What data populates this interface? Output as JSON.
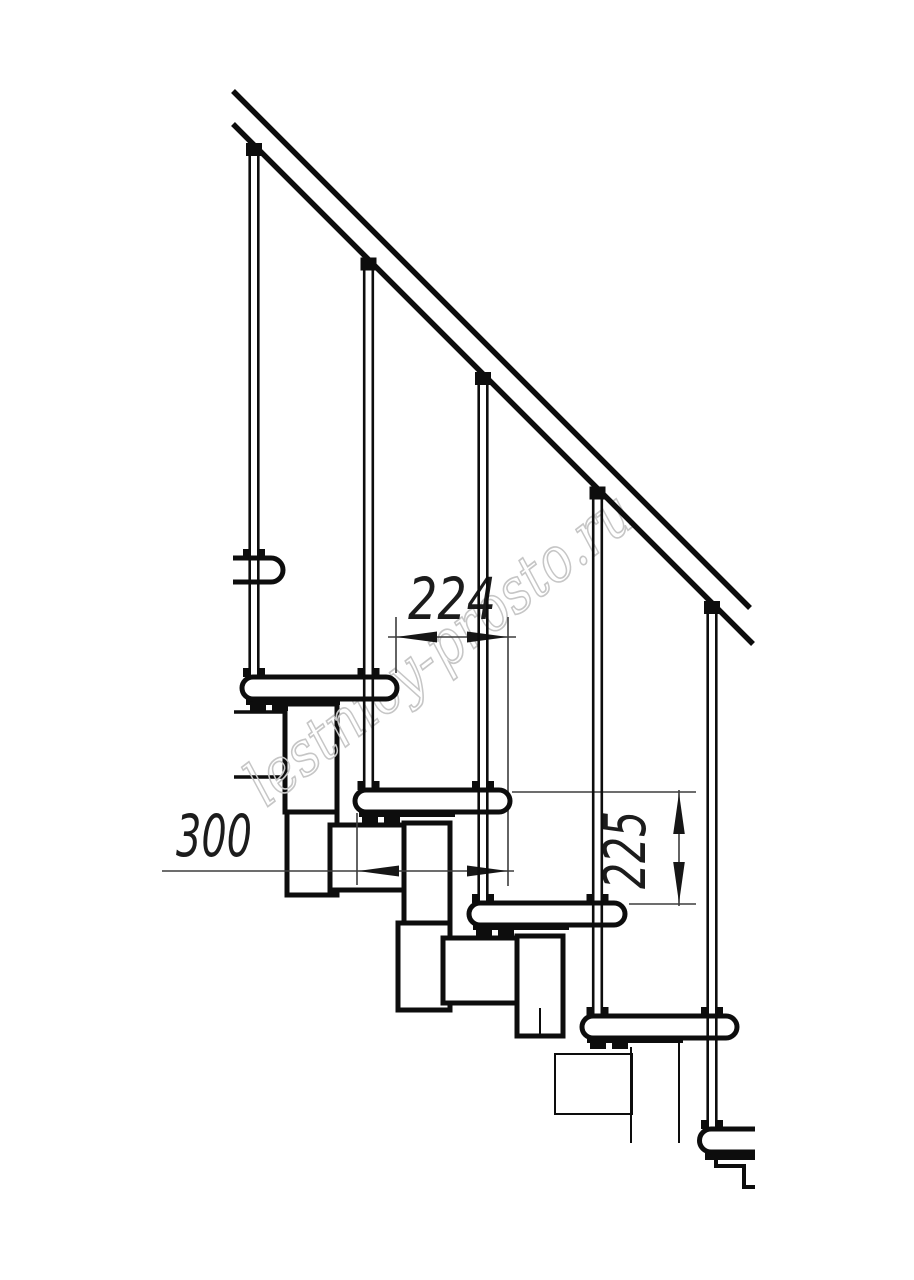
{
  "drawing": {
    "kind": "staircase-side-elevation-technical-drawing",
    "watermark": "lestnicy-prosto.ru",
    "dimensions": {
      "run": "224",
      "tread_depth": "300",
      "riser_height": "225"
    },
    "counts": {
      "balusters": 5,
      "treads": 6
    },
    "colors": {
      "line": "#0d0d0d",
      "dimension_line": "#3d3d3d",
      "dimension_text": "#1c1c1c",
      "watermark": "#c6c6c6",
      "background": "#ffffff"
    }
  }
}
